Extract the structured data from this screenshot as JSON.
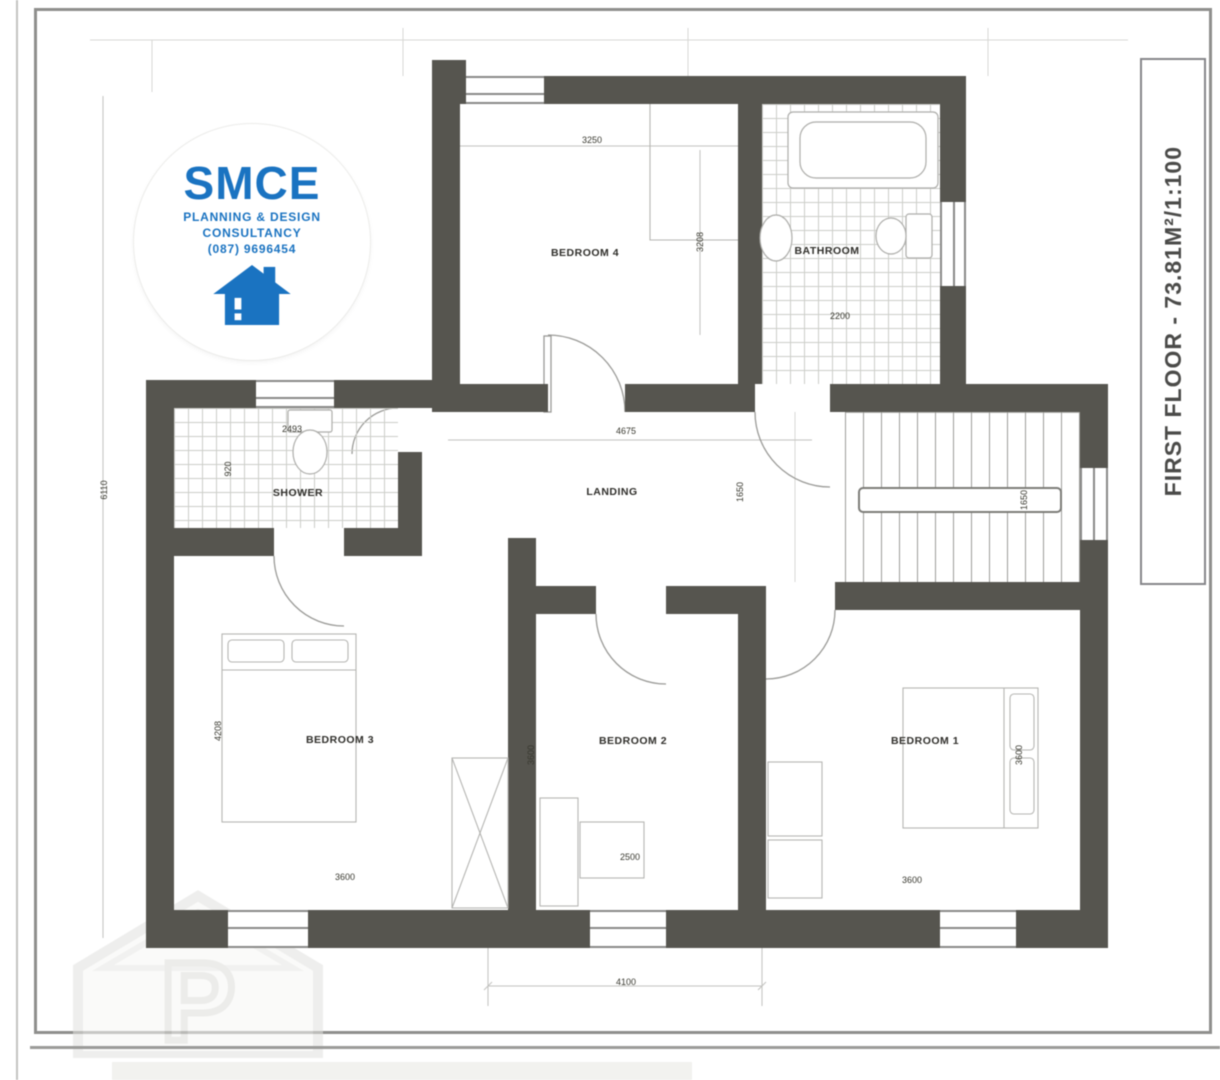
{
  "title_block": {
    "title": "FIRST FLOOR - 73.81M²/1:100"
  },
  "logo": {
    "company": "SMCE",
    "tagline_1": "PLANNING & DESIGN",
    "tagline_2": "CONSULTANCY",
    "phone": "(087) 9696454",
    "accent_color": "#1a73c1",
    "icon": "house-icon"
  },
  "rooms": {
    "bedroom4": {
      "label": "BEDROOM 4"
    },
    "bathroom": {
      "label": "BATHROOM"
    },
    "shower": {
      "label": "SHOWER"
    },
    "landing": {
      "label": "LANDING"
    },
    "bedroom3": {
      "label": "BEDROOM 3"
    },
    "bedroom2": {
      "label": "BEDROOM 2"
    },
    "bedroom1": {
      "label": "BEDROOM 1"
    }
  },
  "dimensions": {
    "bedroom4_width": "3250",
    "bedroom4_depth": "3208",
    "bathroom_width": "2200",
    "shower_width": "2493",
    "shower_depth": "920",
    "landing_width": "4675",
    "stairs_width": "1650",
    "stairs_width_2": "1650",
    "bedroom3_width": "3600",
    "bedroom3_depth": "4208",
    "bedroom2_width": "2500",
    "bedroom2_depth": "3600",
    "bedroom1_width": "3600",
    "bedroom1_depth": "3600",
    "overall_height": "6110",
    "overall_width": "4100"
  },
  "colors": {
    "wall": "#56554f",
    "thin_line": "#9a9a97",
    "dim_text": "#38382f"
  }
}
